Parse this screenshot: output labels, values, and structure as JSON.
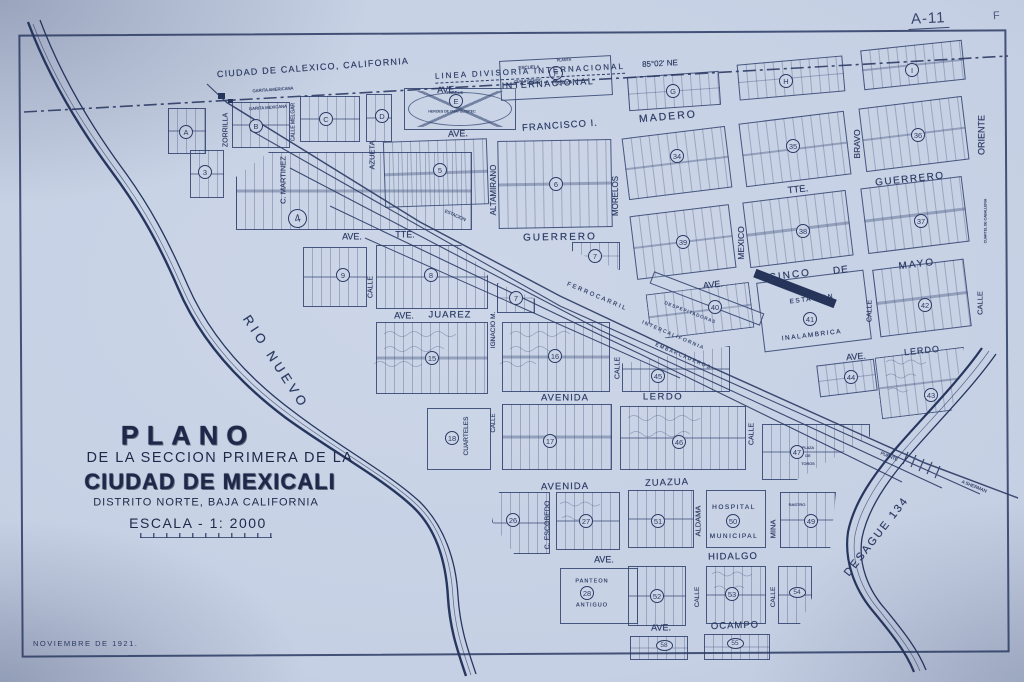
{
  "meta": {
    "sheet_no": "A-11",
    "corner_letter": "F"
  },
  "colors": {
    "paper": "#c6d0e4",
    "ink": "#2c3b64",
    "stamp": "#1e2848"
  },
  "header": {
    "calexico": "CIUDAD DE CALEXICO, CALIFORNIA",
    "boundary": "LINEA DIVISORIA INTERNACIONAL",
    "bearing": "85°02' NE"
  },
  "title_block": {
    "line1": "PLANO",
    "line2": "DE LA SECCION PRIMERA DE LA",
    "line3": "CIUDAD DE MEXICALI",
    "line4": "DISTRITO NORTE, BAJA CALIFORNIA",
    "line5": "ESCALA - 1: 2000",
    "date": "NOVIEMBRE DE 1921."
  },
  "avenues": [
    {
      "t": "AVE.",
      "x": 447,
      "y": 90,
      "r": -3,
      "s": 9
    },
    {
      "t": "INTERNACIONAL",
      "x": 548,
      "y": 84,
      "r": -3,
      "s": 9,
      "ls": 1.5
    },
    {
      "t": "AVE.",
      "x": 458,
      "y": 134,
      "r": -2,
      "s": 9
    },
    {
      "t": "FRANCISCO I.",
      "x": 560,
      "y": 126,
      "r": -4,
      "s": 9.5,
      "ls": 1
    },
    {
      "t": "MADERO",
      "x": 668,
      "y": 117,
      "r": -5,
      "s": 10.5,
      "ls": 2
    },
    {
      "t": "AVE.",
      "x": 352,
      "y": 237,
      "r": 0,
      "s": 9
    },
    {
      "t": "TTE.",
      "x": 405,
      "y": 235,
      "r": 0,
      "s": 9
    },
    {
      "t": "GUERRERO",
      "x": 560,
      "y": 238,
      "r": -1,
      "s": 10,
      "ls": 2
    },
    {
      "t": "TTE.",
      "x": 798,
      "y": 190,
      "r": -6,
      "s": 9.5
    },
    {
      "t": "GUERRERO",
      "x": 910,
      "y": 180,
      "r": -6,
      "s": 10,
      "ls": 1.5
    },
    {
      "t": "AVE.",
      "x": 404,
      "y": 316,
      "r": 0,
      "s": 9
    },
    {
      "t": "JUAREZ",
      "x": 450,
      "y": 315,
      "r": 0,
      "s": 9.5,
      "ls": 1
    },
    {
      "t": "AVE.",
      "x": 713,
      "y": 285,
      "r": -6,
      "s": 9
    },
    {
      "t": "CINCO",
      "x": 790,
      "y": 276,
      "r": -7,
      "s": 10,
      "ls": 2
    },
    {
      "t": "DE",
      "x": 841,
      "y": 271,
      "r": -7,
      "s": 10,
      "ls": 1
    },
    {
      "t": "MAYO",
      "x": 917,
      "y": 265,
      "r": -7,
      "s": 10,
      "ls": 2
    },
    {
      "t": "AVENIDA",
      "x": 565,
      "y": 398,
      "r": 0,
      "s": 9.5,
      "ls": 1
    },
    {
      "t": "LERDO",
      "x": 663,
      "y": 397,
      "r": 0,
      "s": 9.5,
      "ls": 1.5
    },
    {
      "t": "AVE.",
      "x": 856,
      "y": 357,
      "r": -5,
      "s": 9
    },
    {
      "t": "LERDO",
      "x": 922,
      "y": 351,
      "r": -6,
      "s": 9,
      "ls": 1
    },
    {
      "t": "AVENIDA",
      "x": 565,
      "y": 487,
      "r": -1,
      "s": 9.5,
      "ls": 1
    },
    {
      "t": "ZUAZUA",
      "x": 667,
      "y": 483,
      "r": -2,
      "s": 9.5,
      "ls": 1
    },
    {
      "t": "AVE.",
      "x": 604,
      "y": 560,
      "r": 0,
      "s": 9
    },
    {
      "t": "HIDALGO",
      "x": 733,
      "y": 557,
      "r": -1,
      "s": 9.5,
      "ls": 1
    },
    {
      "t": "AVE.",
      "x": 661,
      "y": 628,
      "r": -1,
      "s": 9
    },
    {
      "t": "OCAMPO",
      "x": 735,
      "y": 626,
      "r": -2,
      "s": 9.5,
      "ls": 1
    }
  ],
  "streets": [
    {
      "t": "ZORRILLA",
      "x": 226,
      "y": 130,
      "s": 7
    },
    {
      "t": "C. MARTINEZ",
      "x": 283,
      "y": 180,
      "s": 7.5
    },
    {
      "t": "CALLE MELGAR",
      "x": 294,
      "y": 122,
      "s": 5
    },
    {
      "t": "AZUETA",
      "x": 372,
      "y": 155,
      "s": 7.5
    },
    {
      "t": "ALTAMIRANO",
      "x": 494,
      "y": 190,
      "s": 8
    },
    {
      "t": "MORELOS",
      "x": 616,
      "y": 196,
      "s": 8
    },
    {
      "t": "MEXICO",
      "x": 741,
      "y": 243,
      "s": 8.5
    },
    {
      "t": "BRAVO",
      "x": 857,
      "y": 144,
      "s": 8.5
    },
    {
      "t": "ORIENTE",
      "x": 982,
      "y": 135,
      "s": 9
    },
    {
      "t": "CALLE",
      "x": 371,
      "y": 287,
      "s": 7
    },
    {
      "t": "IGNACIO M.",
      "x": 494,
      "y": 330,
      "s": 6.5
    },
    {
      "t": "CALLE",
      "x": 618,
      "y": 368,
      "s": 7
    },
    {
      "t": "CALLE",
      "x": 870,
      "y": 311,
      "s": 7
    },
    {
      "t": "CALLE",
      "x": 980,
      "y": 303,
      "s": 7.5
    },
    {
      "t": "CUARTELES",
      "x": 467,
      "y": 436,
      "s": 6.5
    },
    {
      "t": "CALLE",
      "x": 494,
      "y": 423,
      "s": 6
    },
    {
      "t": "CALLE",
      "x": 752,
      "y": 434,
      "s": 7
    },
    {
      "t": "C. ESCOBEDO",
      "x": 548,
      "y": 525,
      "s": 7
    },
    {
      "t": "ALDAMA",
      "x": 698,
      "y": 521,
      "s": 7.5
    },
    {
      "t": "MINA",
      "x": 773,
      "y": 529,
      "s": 7.5
    },
    {
      "t": "CALLE",
      "x": 698,
      "y": 597,
      "s": 6.5
    },
    {
      "t": "CALLE",
      "x": 774,
      "y": 597,
      "s": 6.5
    }
  ],
  "blocks": [
    {
      "x": 168,
      "y": 108,
      "w": 38,
      "h": 46
    },
    {
      "x": 232,
      "y": 102,
      "w": 58,
      "h": 46
    },
    {
      "x": 300,
      "y": 96,
      "w": 60,
      "h": 46
    },
    {
      "x": 366,
      "y": 94,
      "w": 26,
      "h": 48
    },
    {
      "x": 404,
      "y": 88,
      "w": 112,
      "h": 42,
      "c": "park"
    },
    {
      "x": 500,
      "y": 58,
      "w": 112,
      "h": 40,
      "r": -3,
      "c": "plain"
    },
    {
      "x": 628,
      "y": 74,
      "w": 92,
      "h": 34,
      "r": -4
    },
    {
      "x": 738,
      "y": 60,
      "w": 106,
      "h": 36,
      "r": -5
    },
    {
      "x": 862,
      "y": 45,
      "w": 102,
      "h": 40,
      "r": -6
    },
    {
      "x": 190,
      "y": 150,
      "w": 34,
      "h": 48
    },
    {
      "x": 236,
      "y": 152,
      "w": 236,
      "h": 78,
      "k": "k-cutNW"
    },
    {
      "x": 384,
      "y": 140,
      "w": 104,
      "h": 66,
      "r": -2
    },
    {
      "x": 498,
      "y": 140,
      "w": 114,
      "h": 88,
      "r": -1
    },
    {
      "x": 303,
      "y": 247,
      "w": 64,
      "h": 60
    },
    {
      "x": 376,
      "y": 245,
      "w": 112,
      "h": 64,
      "k": "k-cutNE"
    },
    {
      "x": 572,
      "y": 242,
      "w": 48,
      "h": 28,
      "k": "k-cutA"
    },
    {
      "x": 497,
      "y": 283,
      "w": 38,
      "h": 30,
      "k": "k-cutB"
    },
    {
      "x": 376,
      "y": 322,
      "w": 112,
      "h": 72
    },
    {
      "x": 502,
      "y": 322,
      "w": 108,
      "h": 70
    },
    {
      "x": 622,
      "y": 346,
      "w": 108,
      "h": 46,
      "k": "k-cutT45"
    },
    {
      "x": 427,
      "y": 408,
      "w": 64,
      "h": 62,
      "c": "plain"
    },
    {
      "x": 502,
      "y": 404,
      "w": 110,
      "h": 66
    },
    {
      "x": 620,
      "y": 406,
      "w": 126,
      "h": 64
    },
    {
      "x": 762,
      "y": 424,
      "w": 108,
      "h": 56,
      "k": "k-cut47"
    },
    {
      "x": 492,
      "y": 492,
      "w": 58,
      "h": 62,
      "k": "k-cut26"
    },
    {
      "x": 556,
      "y": 492,
      "w": 64,
      "h": 58
    },
    {
      "x": 628,
      "y": 490,
      "w": 66,
      "h": 58
    },
    {
      "x": 706,
      "y": 490,
      "w": 60,
      "h": 58,
      "c": "plain"
    },
    {
      "x": 780,
      "y": 492,
      "w": 56,
      "h": 56,
      "k": "k-cut49"
    },
    {
      "x": 560,
      "y": 568,
      "w": 78,
      "h": 56,
      "c": "plain"
    },
    {
      "x": 628,
      "y": 566,
      "w": 58,
      "h": 60
    },
    {
      "x": 706,
      "y": 566,
      "w": 60,
      "h": 58
    },
    {
      "x": 778,
      "y": 566,
      "w": 34,
      "h": 58,
      "k": "k-cut54"
    },
    {
      "x": 630,
      "y": 636,
      "w": 58,
      "h": 24
    },
    {
      "x": 704,
      "y": 634,
      "w": 66,
      "h": 26
    },
    {
      "x": 625,
      "y": 132,
      "w": 104,
      "h": 62,
      "r": -7
    },
    {
      "x": 742,
      "y": 117,
      "w": 106,
      "h": 64,
      "r": -7
    },
    {
      "x": 862,
      "y": 102,
      "w": 104,
      "h": 64,
      "r": -7
    },
    {
      "x": 633,
      "y": 210,
      "w": 100,
      "h": 64,
      "r": -7
    },
    {
      "x": 746,
      "y": 196,
      "w": 104,
      "h": 66,
      "r": -7
    },
    {
      "x": 864,
      "y": 182,
      "w": 102,
      "h": 66,
      "r": -7
    },
    {
      "x": 648,
      "y": 288,
      "w": 104,
      "h": 46,
      "r": -7,
      "k": "k-cut40"
    },
    {
      "x": 760,
      "y": 276,
      "w": 108,
      "h": 70,
      "r": -7,
      "c": "plain"
    },
    {
      "x": 876,
      "y": 264,
      "w": 92,
      "h": 68,
      "r": -7
    },
    {
      "x": 818,
      "y": 362,
      "w": 58,
      "h": 32,
      "r": -7
    },
    {
      "x": 878,
      "y": 352,
      "w": 90,
      "h": 62,
      "r": -7,
      "k": "k-cut43"
    },
    {
      "x": 648,
      "y": 292,
      "w": 118,
      "h": 13,
      "r": 21,
      "c": "plain"
    }
  ],
  "station_bar": {
    "x": 752,
    "y": 284,
    "w": 86,
    "h": 9,
    "r": 21
  },
  "block_labels": [
    {
      "t": "A",
      "x": 186,
      "y": 132
    },
    {
      "t": "B",
      "x": 256,
      "y": 126
    },
    {
      "t": "C",
      "x": 326,
      "y": 119
    },
    {
      "t": "D",
      "x": 382,
      "y": 116
    },
    {
      "t": "E",
      "x": 456,
      "y": 101
    },
    {
      "t": "F",
      "x": 556,
      "y": 73
    },
    {
      "t": "G",
      "x": 673,
      "y": 91
    },
    {
      "t": "H",
      "x": 786,
      "y": 81
    },
    {
      "t": "I",
      "x": 912,
      "y": 70
    },
    {
      "t": "3",
      "x": 205,
      "y": 172
    },
    {
      "t": "4",
      "x": 297,
      "y": 218,
      "f": "big"
    },
    {
      "t": "5",
      "x": 440,
      "y": 170
    },
    {
      "t": "6",
      "x": 556,
      "y": 184
    },
    {
      "t": "7",
      "x": 595,
      "y": 256
    },
    {
      "t": "7",
      "x": 516,
      "y": 298
    },
    {
      "t": "8",
      "x": 431,
      "y": 275
    },
    {
      "t": "9",
      "x": 343,
      "y": 275
    },
    {
      "t": "15",
      "x": 432,
      "y": 358
    },
    {
      "t": "16",
      "x": 555,
      "y": 356
    },
    {
      "t": "17",
      "x": 550,
      "y": 441
    },
    {
      "t": "18",
      "x": 452,
      "y": 438
    },
    {
      "t": "26",
      "x": 513,
      "y": 520
    },
    {
      "t": "27",
      "x": 586,
      "y": 521
    },
    {
      "t": "28",
      "x": 587,
      "y": 593
    },
    {
      "t": "34",
      "x": 677,
      "y": 156
    },
    {
      "t": "35",
      "x": 793,
      "y": 146
    },
    {
      "t": "36",
      "x": 918,
      "y": 135
    },
    {
      "t": "37",
      "x": 921,
      "y": 221
    },
    {
      "t": "38",
      "x": 803,
      "y": 231
    },
    {
      "t": "39",
      "x": 683,
      "y": 242
    },
    {
      "t": "40",
      "x": 715,
      "y": 307
    },
    {
      "t": "41",
      "x": 810,
      "y": 319
    },
    {
      "t": "42",
      "x": 925,
      "y": 305
    },
    {
      "t": "43",
      "x": 931,
      "y": 395
    },
    {
      "t": "44",
      "x": 851,
      "y": 377
    },
    {
      "t": "45",
      "x": 658,
      "y": 376
    },
    {
      "t": "46",
      "x": 679,
      "y": 442
    },
    {
      "t": "47",
      "x": 797,
      "y": 452
    },
    {
      "t": "49",
      "x": 811,
      "y": 521
    },
    {
      "t": "50",
      "x": 733,
      "y": 521
    },
    {
      "t": "51",
      "x": 658,
      "y": 521
    },
    {
      "t": "52",
      "x": 657,
      "y": 596
    },
    {
      "t": "53",
      "x": 732,
      "y": 594
    },
    {
      "t": "54",
      "x": 797,
      "y": 592,
      "f": "oval"
    },
    {
      "t": "58",
      "x": 664,
      "y": 645,
      "f": "oval"
    },
    {
      "t": "55",
      "x": 735,
      "y": 643,
      "f": "oval"
    }
  ],
  "features": [
    {
      "t": "PARQUE",
      "x": 455,
      "y": 93,
      "s": 4
    },
    {
      "t": "HEROES DE CHAPULTEPEC",
      "x": 452,
      "y": 112,
      "s": 3.5
    },
    {
      "t": "ESCUELA",
      "x": 529,
      "y": 68,
      "s": 4.5,
      "r": -3
    },
    {
      "t": "CUAUHTEMOC",
      "x": 528,
      "y": 82,
      "s": 3.8,
      "r": -3
    },
    {
      "t": "PLANTA",
      "x": 564,
      "y": 61,
      "s": 3.8,
      "r": -3
    },
    {
      "t": "DE AGUA",
      "x": 564,
      "y": 84,
      "s": 3.8,
      "r": -3
    },
    {
      "t": "GARITA AMERICANA",
      "x": 273,
      "y": 90,
      "s": 4.2,
      "r": -4
    },
    {
      "t": "GARITA MEXICANA",
      "x": 268,
      "y": 108,
      "s": 4.2,
      "r": -4
    },
    {
      "t": "ESTACION",
      "x": 455,
      "y": 216,
      "s": 4.5,
      "r": 24
    },
    {
      "t": "ESTACION",
      "x": 812,
      "y": 300,
      "s": 6.5,
      "r": -7,
      "ls": 1.5
    },
    {
      "t": "INALAMBRICA",
      "x": 812,
      "y": 336,
      "s": 6.5,
      "r": -7,
      "ls": 1.5
    },
    {
      "t": "HOSPITAL",
      "x": 734,
      "y": 508,
      "s": 6.5,
      "ls": 1.5
    },
    {
      "t": "MUNICIPAL",
      "x": 734,
      "y": 537,
      "s": 6.5,
      "ls": 1.5
    },
    {
      "t": "RASTRO",
      "x": 797,
      "y": 505,
      "s": 4
    },
    {
      "t": "PANTEON",
      "x": 592,
      "y": 582,
      "s": 5.5,
      "ls": 1
    },
    {
      "t": "ANTIGUO",
      "x": 592,
      "y": 606,
      "s": 5.5,
      "ls": 1
    },
    {
      "t": "PLAZA",
      "x": 808,
      "y": 449,
      "s": 3.8
    },
    {
      "t": "DE",
      "x": 808,
      "y": 457,
      "s": 3.8
    },
    {
      "t": "TOROS",
      "x": 808,
      "y": 465,
      "s": 3.8
    },
    {
      "t": "CUARTEL DE CABALLERIA",
      "x": 986,
      "y": 221,
      "s": 3.5,
      "r": -90
    }
  ],
  "rail_labels": [
    {
      "t": "FERROCARRIL",
      "x": 597,
      "y": 297,
      "s": 6,
      "r": 23,
      "ls": 2
    },
    {
      "t": "INTERCALIFORNIA",
      "x": 673,
      "y": 336,
      "s": 5,
      "r": 23,
      "ls": 1.5
    },
    {
      "t": "EMBARCADEROS",
      "x": 683,
      "y": 357,
      "s": 5,
      "r": 23,
      "ls": 1.5
    },
    {
      "t": "DESPEPITADORAS",
      "x": 690,
      "y": 313,
      "s": 4.5,
      "r": 21,
      "ls": 1
    }
  ],
  "water_labels": [
    {
      "t": "RIO NUEVO",
      "x": 276,
      "y": 362,
      "s": 13,
      "r": 57,
      "ls": 4
    },
    {
      "t": "DESAGUE 134",
      "x": 877,
      "y": 537,
      "s": 11,
      "r": -52,
      "ls": 2
    },
    {
      "t": "PUENTE",
      "x": 889,
      "y": 457,
      "s": 4.5,
      "r": 22
    },
    {
      "t": "A SHERMAN",
      "x": 974,
      "y": 487,
      "s": 4.5,
      "r": 22
    }
  ]
}
